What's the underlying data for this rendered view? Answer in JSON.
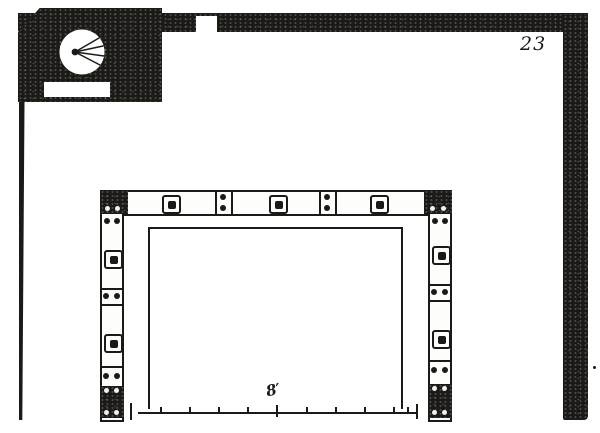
{
  "page": {
    "number": "23"
  },
  "scale": {
    "label": "8′"
  },
  "palette": {
    "ink": "#1c1a16",
    "paper": "#ffffff"
  },
  "icons": {
    "fanlight": "fanlight-icon",
    "bolt": "bolt-icon",
    "rivet": "rivet-icon"
  }
}
